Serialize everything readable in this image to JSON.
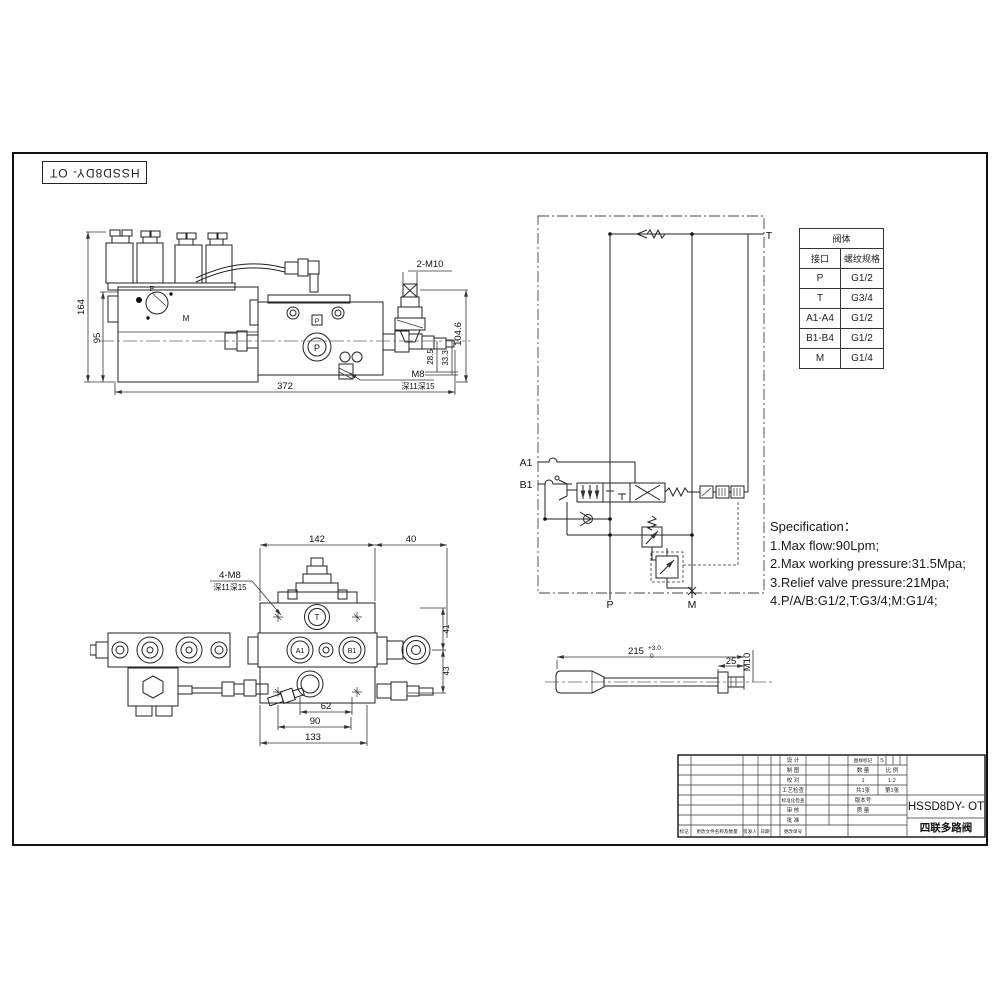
{
  "doc": {
    "code_rotated": "HSSD8DY- OT"
  },
  "side_view": {
    "labels": {
      "p_top": "P",
      "m": "M",
      "p_port": "P",
      "p_small": "P"
    },
    "dims": {
      "h164": "164",
      "h95": "95",
      "w372": "372",
      "h104_6": "104.6",
      "h28_5": "28.5",
      "h33_3": "33.3",
      "thread_2m10": "2-M10",
      "thread_m8": "M8",
      "depth_note": "深11深15"
    }
  },
  "schematic": {
    "ports": {
      "t": "T",
      "a1": "A1",
      "b1": "B1",
      "p": "P",
      "m": "M"
    }
  },
  "port_table": {
    "title": "阀体",
    "col_interface": "接口",
    "col_thread": "螺纹规格",
    "rows": [
      {
        "port": "P",
        "thread": "G1/2"
      },
      {
        "port": "T",
        "thread": "G3/4"
      },
      {
        "port": "A1-A4",
        "thread": "G1/2"
      },
      {
        "port": "B1-B4",
        "thread": "G1/2"
      },
      {
        "port": "M",
        "thread": "G1/4"
      }
    ]
  },
  "specification": {
    "title": "Specification：",
    "line1": "1.Max flow:90Lpm;",
    "line2": "2.Max working pressure:31.5Mpa;",
    "line3": "3.Relief valve pressure:21Mpa;",
    "line4": "4.P/A/B:G1/2,T:G3/4;M:G1/4;"
  },
  "front_view": {
    "labels": {
      "t": "T",
      "a1": "A1",
      "b1": "B1"
    },
    "dims": {
      "w142": "142",
      "w40": "40",
      "note_4m8": "4-M8",
      "depth_note": "深11深15",
      "h41": "41",
      "h43": "43",
      "w62": "62",
      "w90": "90",
      "w133": "133"
    }
  },
  "handle_view": {
    "dims": {
      "len215": "215",
      "tol_upper": "+3.0",
      "tol_lower": "0",
      "len25": "25",
      "thread_m10": "M10"
    }
  },
  "title_block": {
    "row_labels": [
      "设 计",
      "制 图",
      "校 对",
      "工艺检查",
      "标准化检查",
      "审 核",
      "批 准"
    ],
    "bottom_labels": {
      "mark": "标记",
      "change": "更改文件名称及数量",
      "signer": "签发人",
      "date": "日期",
      "order": "更改单号"
    },
    "drawing_mark_label": "图样标记",
    "drawing_mark_value": "S",
    "qty_label": "数 量",
    "scale_label": "比 例",
    "qty_value": "1",
    "scale_value": "1:2",
    "sheet_total": "共1张",
    "sheet_no": "第1张",
    "version_label": "版本号",
    "mass_label": "质 量",
    "model": "HSSD8DY- OT",
    "product_name": "四联多路阀"
  }
}
